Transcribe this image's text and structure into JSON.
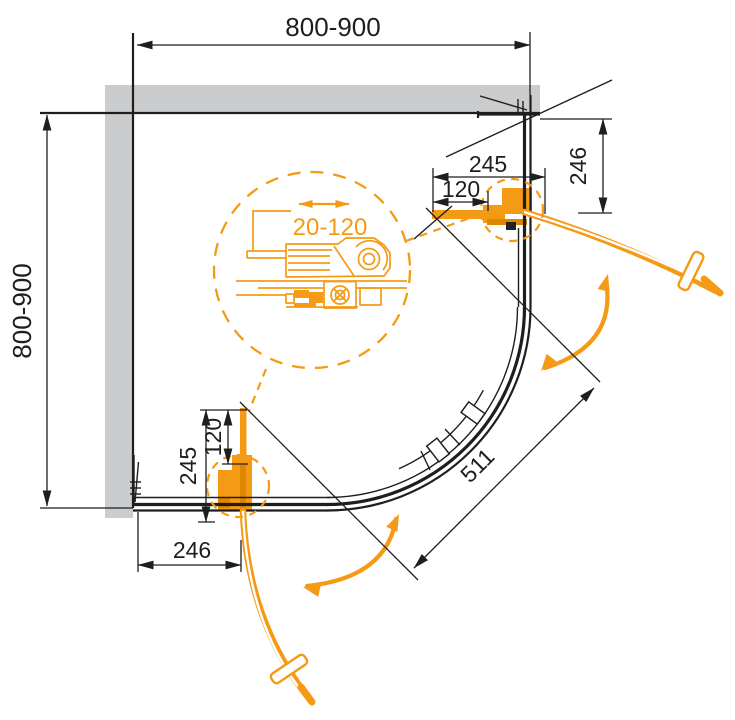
{
  "colors": {
    "orange": "#f49a15",
    "orange_dark": "#de8600",
    "ink": "#1e1e1e",
    "wall_gray": "#cbccce"
  },
  "dims": {
    "top": "800-900",
    "left": "800-900",
    "r245": "245",
    "r120": "120",
    "r246": "246",
    "b245": "245",
    "b120": "120",
    "b246": "246",
    "diag": "511",
    "adjust": "20-120"
  }
}
